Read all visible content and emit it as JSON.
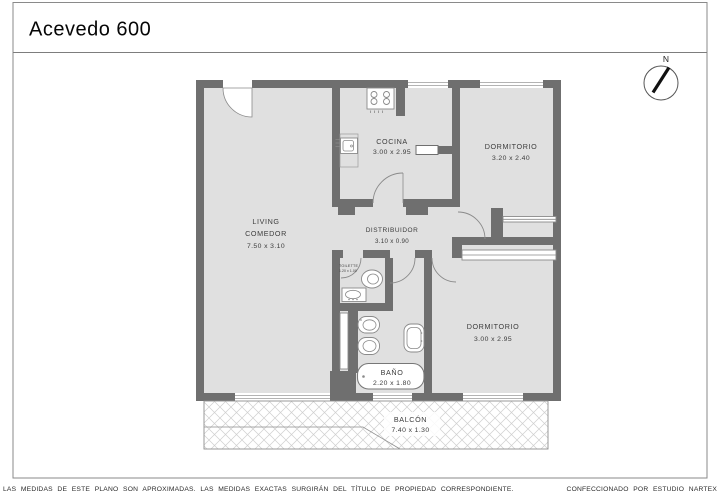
{
  "title": "Acevedo 600",
  "compass": {
    "label": "N"
  },
  "rooms": {
    "living": {
      "line1": "LIVING",
      "line2": "COMEDOR",
      "dims": "7.50 x 3.10"
    },
    "cocina": {
      "name": "COCINA",
      "dims": "3.00 x 2.95"
    },
    "dormitorio1": {
      "name": "DORMITORIO",
      "dims": "3.20 x 2.40"
    },
    "distribuidor": {
      "name": "DISTRIBUIDOR",
      "dims": "3.10 x 0.90"
    },
    "toilette": {
      "name": "TOILETTE",
      "dims": "1.20 x 1.00"
    },
    "bano": {
      "name": "BAÑO",
      "dims": "2.20 x 1.80"
    },
    "dormitorio2": {
      "name": "DORMITORIO",
      "dims": "3.00 x 2.95"
    },
    "balcon": {
      "name": "BALCÓN",
      "dims": "7.40 x 1.30"
    }
  },
  "footer": {
    "disclaimer": "LAS MEDIDAS  DE ESTE PLANO SON APROXIMADAS. LAS MEDIDAS EXACTAS SURGIRÁN DEL TÍTULO DE PROPIEDAD CORRESPONDIENTE.",
    "credit": "CONFECCIONADO POR ESTUDIO NARTEX"
  },
  "colors": {
    "wall": "#6f6f6f",
    "floor": "#e0e0e0",
    "hatch": "#cfcfcf",
    "outline": "#8a8a8a",
    "text": "#3c3c3c"
  }
}
